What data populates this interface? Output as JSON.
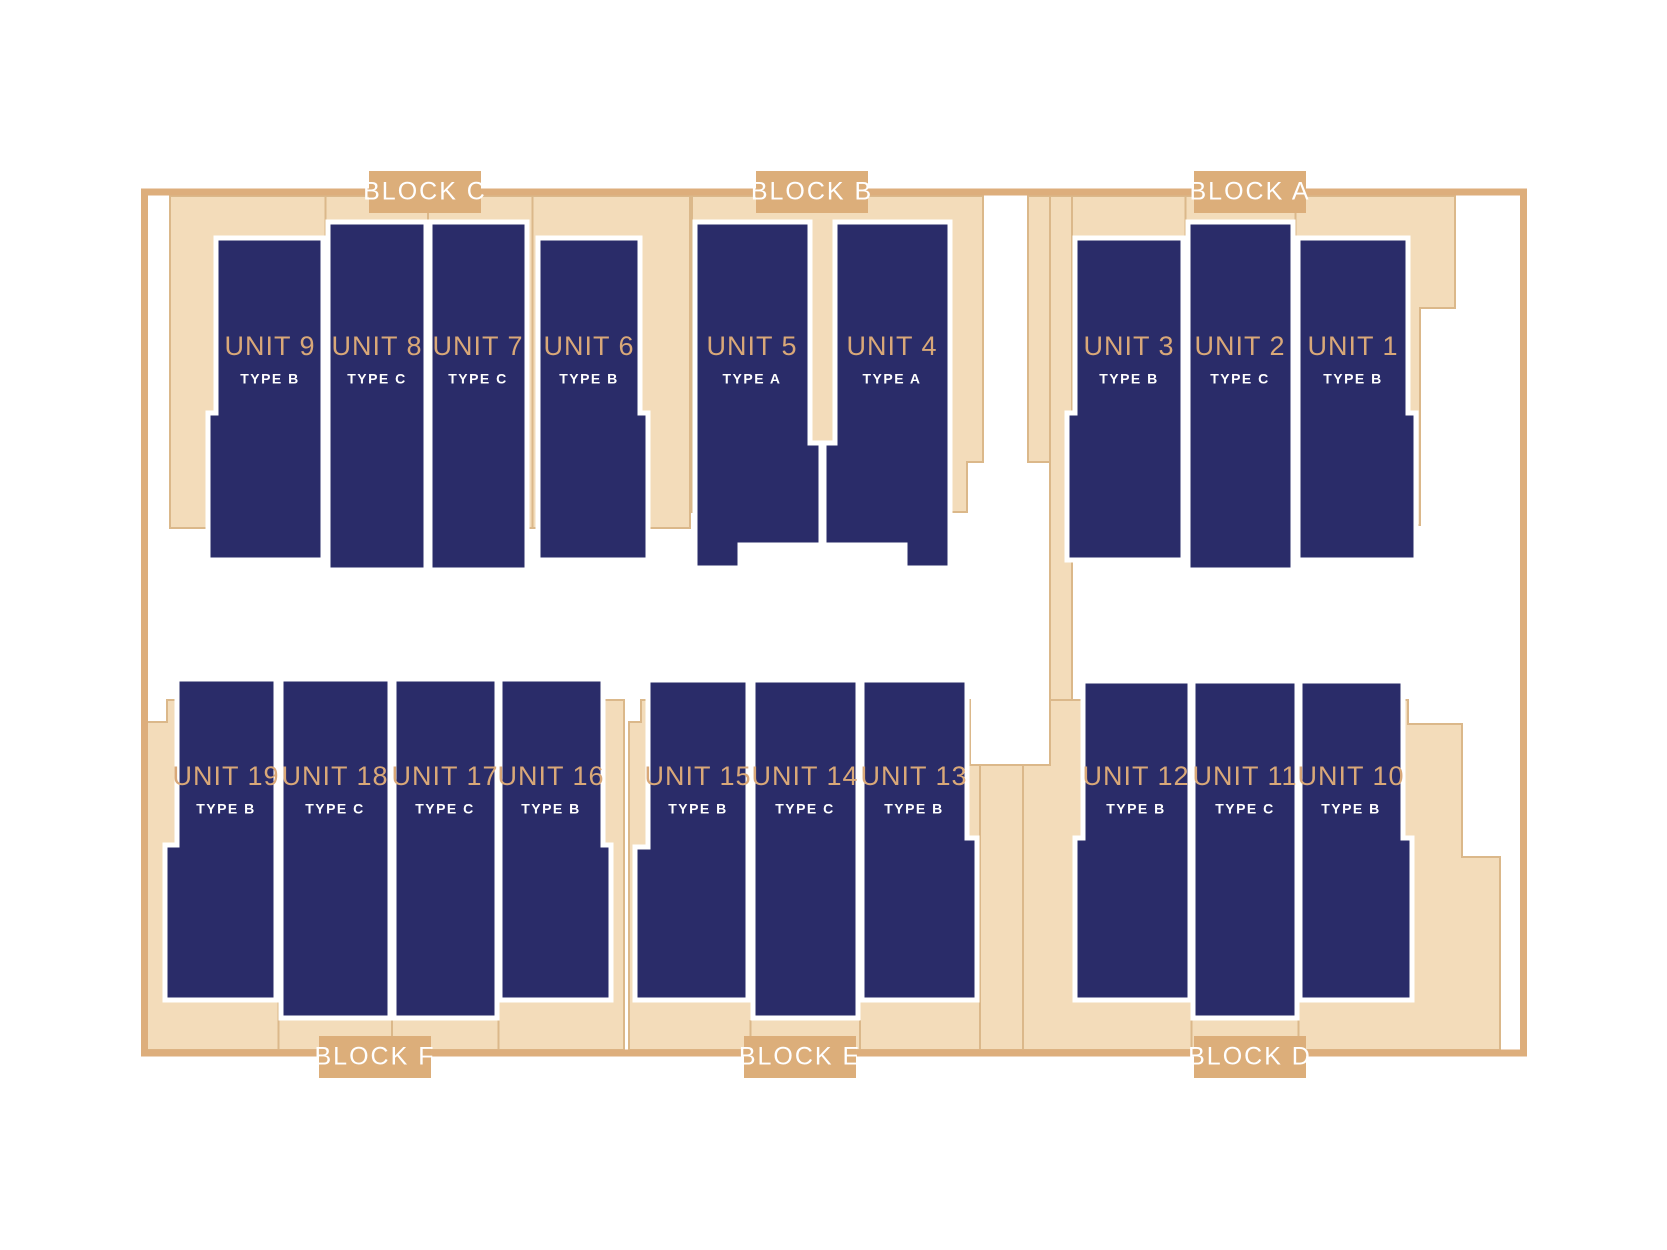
{
  "plan": {
    "blocks": [
      {
        "id": "C",
        "label": "BLOCK C",
        "position": "top"
      },
      {
        "id": "B",
        "label": "BLOCK B",
        "position": "top"
      },
      {
        "id": "A",
        "label": "BLOCK A",
        "position": "top"
      },
      {
        "id": "F",
        "label": "BLOCK F",
        "position": "bottom"
      },
      {
        "id": "E",
        "label": "BLOCK E",
        "position": "bottom"
      },
      {
        "id": "D",
        "label": "BLOCK D",
        "position": "bottom"
      }
    ],
    "units": [
      {
        "name": "UNIT 9",
        "type": "TYPE B",
        "block": "C"
      },
      {
        "name": "UNIT 8",
        "type": "TYPE C",
        "block": "C"
      },
      {
        "name": "UNIT 7",
        "type": "TYPE C",
        "block": "C"
      },
      {
        "name": "UNIT 6",
        "type": "TYPE B",
        "block": "C"
      },
      {
        "name": "UNIT 5",
        "type": "TYPE A",
        "block": "B"
      },
      {
        "name": "UNIT 4",
        "type": "TYPE A",
        "block": "B"
      },
      {
        "name": "UNIT 3",
        "type": "TYPE B",
        "block": "A"
      },
      {
        "name": "UNIT 2",
        "type": "TYPE C",
        "block": "A"
      },
      {
        "name": "UNIT 1",
        "type": "TYPE B",
        "block": "A"
      },
      {
        "name": "UNIT 19",
        "type": "TYPE B",
        "block": "F"
      },
      {
        "name": "UNIT 18",
        "type": "TYPE C",
        "block": "F"
      },
      {
        "name": "UNIT 17",
        "type": "TYPE C",
        "block": "F"
      },
      {
        "name": "UNIT 16",
        "type": "TYPE B",
        "block": "F"
      },
      {
        "name": "UNIT 15",
        "type": "TYPE B",
        "block": "E"
      },
      {
        "name": "UNIT 14",
        "type": "TYPE C",
        "block": "E"
      },
      {
        "name": "UNIT 13",
        "type": "TYPE B",
        "block": "E"
      },
      {
        "name": "UNIT 12",
        "type": "TYPE B",
        "block": "D"
      },
      {
        "name": "UNIT 11",
        "type": "TYPE C",
        "block": "D"
      },
      {
        "name": "UNIT 10",
        "type": "TYPE B",
        "block": "D"
      }
    ]
  },
  "colors": {
    "background": "#FFFFFF",
    "unit_fill": "#2A2C69",
    "unit_name_text": "#D9A878",
    "unit_type_text": "#FFFFFF",
    "plot_fill": "#F3DCBA",
    "plot_outline": "#DBB88A",
    "boundary": "#DDAE7C",
    "block_label_bg": "#DCAE7A",
    "block_label_text": "#FFFFFF"
  }
}
